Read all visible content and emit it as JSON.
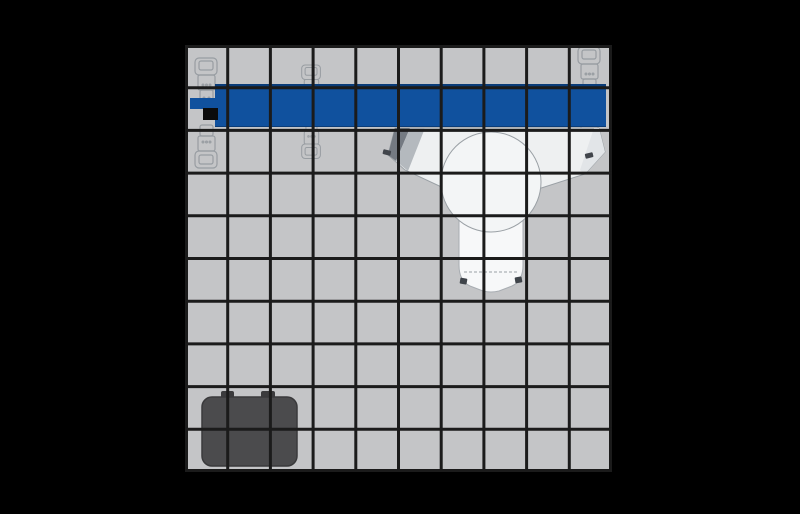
{
  "meta": {
    "view": "top-down workcell layout",
    "canvas_width_px": 800,
    "canvas_height_px": 514
  },
  "colors": {
    "background": "#000000",
    "floor": "#c4c5c7",
    "grid_line": "#1b1b1b",
    "conveyor_blue": "#10519e",
    "conveyor_edge_dark": "#0a3c78",
    "end_block_black": "#0b0b0b",
    "machine_body": "#eef0f1",
    "machine_circle": "#f3f5f6",
    "machine_column": "#f7f8f9",
    "machine_outline": "#9aa0a5",
    "machine_shadow_dark": "#747a82",
    "machine_shadow_mid": "#b4b9be",
    "stand_outline": "#989da2",
    "container_fill": "#4b4b4d",
    "container_edge": "#3a3a3c",
    "container_bump": "#3b3b3d"
  },
  "scene": {
    "grid": {
      "columns": 10,
      "rows": 10,
      "size_px": 427,
      "line_width_px": 3
    },
    "objects": [
      {
        "name": "conveyor-belt",
        "type": "conveyor",
        "color_ref": "conveyor_blue"
      },
      {
        "name": "conveyor-side-tab",
        "type": "conveyor-extension",
        "color_ref": "conveyor_blue"
      },
      {
        "name": "conveyor-end-block",
        "type": "block",
        "color_ref": "end_block_black"
      },
      {
        "name": "conveyor-stand-left",
        "type": "support-stand"
      },
      {
        "name": "conveyor-stand-middle",
        "type": "support-stand"
      },
      {
        "name": "conveyor-stand-right",
        "type": "support-stand"
      },
      {
        "name": "machine-unit",
        "type": "machine-top-view",
        "color_ref": "machine_body"
      },
      {
        "name": "container-box",
        "type": "container",
        "color_ref": "container_fill"
      }
    ]
  }
}
